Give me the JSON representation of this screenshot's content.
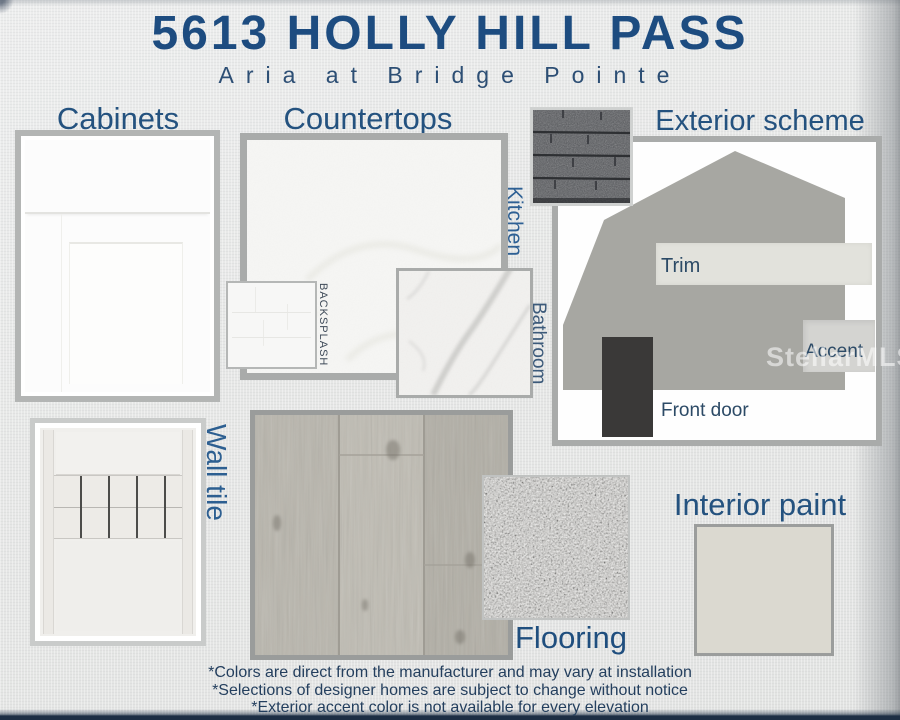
{
  "header": {
    "title": "5613 HOLLY HILL PASS",
    "subtitle": "Aria at Bridge Pointe"
  },
  "sections": {
    "cabinets": {
      "label": "Cabinets"
    },
    "countertops": {
      "label": "Countertops",
      "kitchen_label": "Kitchen",
      "backsplash_label": "BACKSPLASH",
      "bathroom_label": "Bathroom"
    },
    "exterior": {
      "label": "Exterior scheme",
      "trim_label": "Trim",
      "accent_label": "Accent",
      "front_door_label": "Front door"
    },
    "wall_tile": {
      "label": "Wall tile"
    },
    "flooring": {
      "label": "Flooring"
    },
    "interior_paint": {
      "label": "Interior paint"
    }
  },
  "watermark": "StellarMLS",
  "footnotes": [
    "*Colors are direct from the manufacturer and may vary at installation",
    "*Selections of designer homes are subject to change without notice",
    "*Exterior accent color is not available for every elevation"
  ],
  "colors": {
    "heading_blue": "#24527f",
    "title_blue": "#1d4c80",
    "house_gray": "#a7a7a2",
    "trim": "#e2e2dc",
    "accent": "#d4d4d1",
    "front_door": "#3a3938",
    "shingle_dark": "#54565a",
    "quartz_base": "#f6f6f4",
    "marble_base": "#f2f1ef",
    "flooring_wood": "#b9b6ad",
    "carpet_base": "#cbcac7",
    "interior_paint_swatch": "#dbd9d0",
    "cabinet_white": "#fcfcfc"
  }
}
